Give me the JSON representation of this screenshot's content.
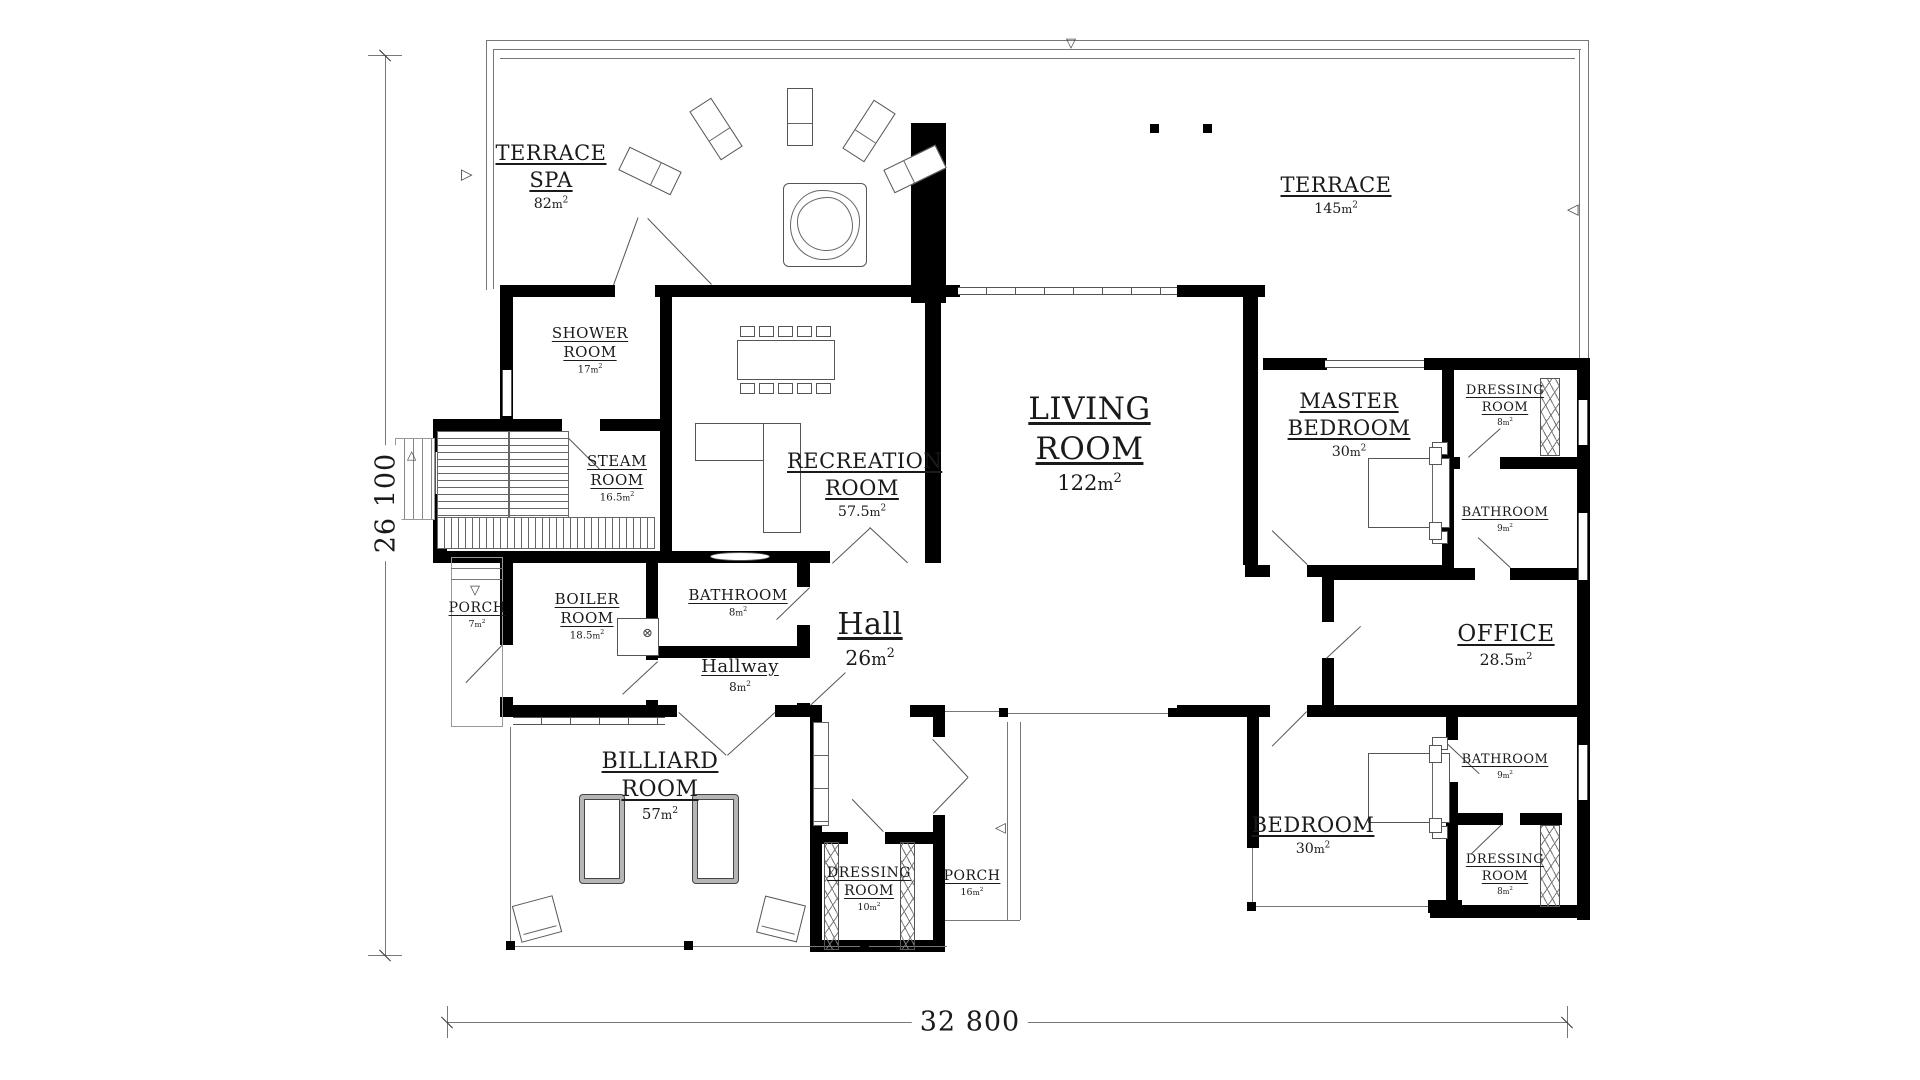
{
  "drawing": {
    "type": "floor-plan",
    "dims": {
      "width": "32 800",
      "height": "26 100"
    }
  },
  "units": {
    "m": "m",
    "sup": "2"
  },
  "icons": {
    "up_arrow": "△",
    "down_arrow": "▽",
    "left_arrow": "◁",
    "right_arrow": "▷",
    "boiler_valve": "⊗"
  },
  "rooms": [
    {
      "id": "terrace-spa",
      "name": "TERRACE SPA",
      "area": "82"
    },
    {
      "id": "terrace",
      "name": "TERRACE",
      "area": "145"
    },
    {
      "id": "shower-room",
      "name": "SHOWER ROOM",
      "area": "17"
    },
    {
      "id": "steam-room",
      "name": "STEAM ROOM",
      "area": "16.5"
    },
    {
      "id": "recreation-room",
      "name": "RECREATION ROOM",
      "area": "57.5"
    },
    {
      "id": "living-room",
      "name": "LIVING ROOM",
      "area": "122"
    },
    {
      "id": "master-bedroom",
      "name": "MASTER BEDROOM",
      "area": "30"
    },
    {
      "id": "dressing-room-master",
      "name": "DRESSING ROOM",
      "area": "8"
    },
    {
      "id": "bathroom-master",
      "name": "BATHROOM",
      "area": "9"
    },
    {
      "id": "porch-west",
      "name": "PORCH",
      "area": "7"
    },
    {
      "id": "boiler-room",
      "name": "BOILER ROOM",
      "area": "18.5"
    },
    {
      "id": "bathroom-hall",
      "name": "BATHROOM",
      "area": "8"
    },
    {
      "id": "hall",
      "name": "Hall",
      "area": "26"
    },
    {
      "id": "hallway",
      "name": "Hallway",
      "area": "8"
    },
    {
      "id": "office",
      "name": "OFFICE",
      "area": "28.5"
    },
    {
      "id": "billiard-room",
      "name": "BILLIARD ROOM",
      "area": "57"
    },
    {
      "id": "dressing-room-entry",
      "name": "DRESSING ROOM",
      "area": "10"
    },
    {
      "id": "porch-south",
      "name": "PORCH",
      "area": "16"
    },
    {
      "id": "bedroom",
      "name": "BEDROOM",
      "area": "30"
    },
    {
      "id": "bathroom-bedroom",
      "name": "BATHROOM",
      "area": "9"
    },
    {
      "id": "dressing-room-bedroom",
      "name": "DRESSING ROOM",
      "area": "8"
    }
  ]
}
